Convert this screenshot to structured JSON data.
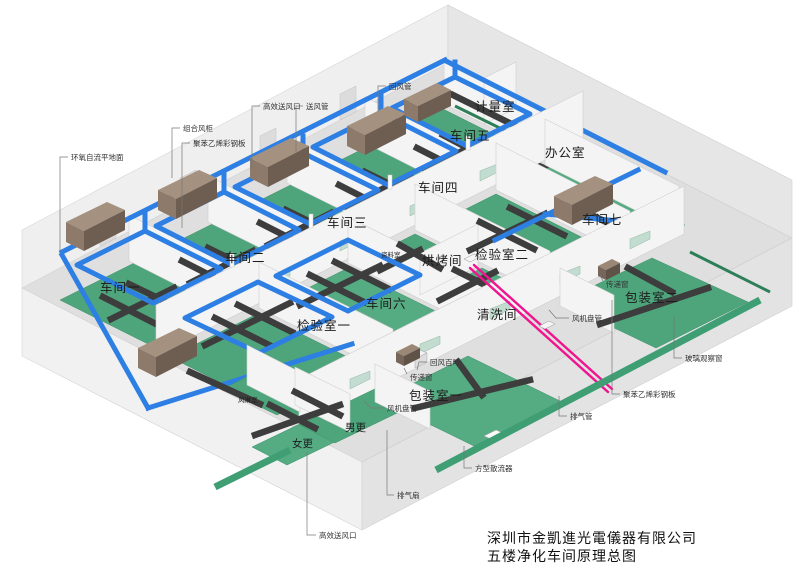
{
  "title_block": {
    "company": "深圳市金凱進光電儀器有限公司",
    "drawing_title": "五楼净化车间原理总图"
  },
  "rooms": {
    "workshop1": "车间一",
    "workshop2": "车间二",
    "workshop3": "车间三",
    "workshop4": "车间四",
    "workshop5": "车间五",
    "workshop6": "车间六",
    "workshop7": "车间七",
    "metrology_room": "计量室",
    "office": "办公室",
    "inspection_room1": "检验室一",
    "inspection_room2": "检验室二",
    "baking_room": "烘烤间",
    "cleaning_room": "清洗间",
    "data_room": "资料室",
    "packing_room1": "包装室一",
    "packing_room2": "包装室二",
    "air_shower_room": "风淋室",
    "women_changing": "女更",
    "men_changing": "男更"
  },
  "callouts": {
    "epoxy_floor": "环氧自流平地面",
    "combined_ahu": "组合风柜",
    "polystyrene_panel_top": "聚苯乙烯彩钢板",
    "hepa_outlet_top": "高效送风口",
    "supply_duct": "送风管",
    "return_duct": "回风管",
    "return_louver": "回风百叶",
    "pass_window_center": "传递窗",
    "pass_window_right": "传递窗",
    "fan_coil_center": "风机盘管",
    "fan_coil_right": "风机盘管",
    "glass_window": "玻璃观察窗",
    "polystyrene_panel_right": "聚苯乙烯彩钢板",
    "exhaust_duct": "排气管",
    "square_diffuser": "方型散流器",
    "exhaust_fan": "排气扇",
    "hepa_outlet_bottom": "高效送风口"
  },
  "colors": {
    "supply_return_duct_blue": "#2e7fe3",
    "fan_coil_duct_dark": "#3d3d3d",
    "exhaust_duct_pink": "#f0148e",
    "cleanroom_floor_green": "#4ea57c",
    "ahu_brown": "#9b8775",
    "structure_gray": "#e8e8e8"
  }
}
